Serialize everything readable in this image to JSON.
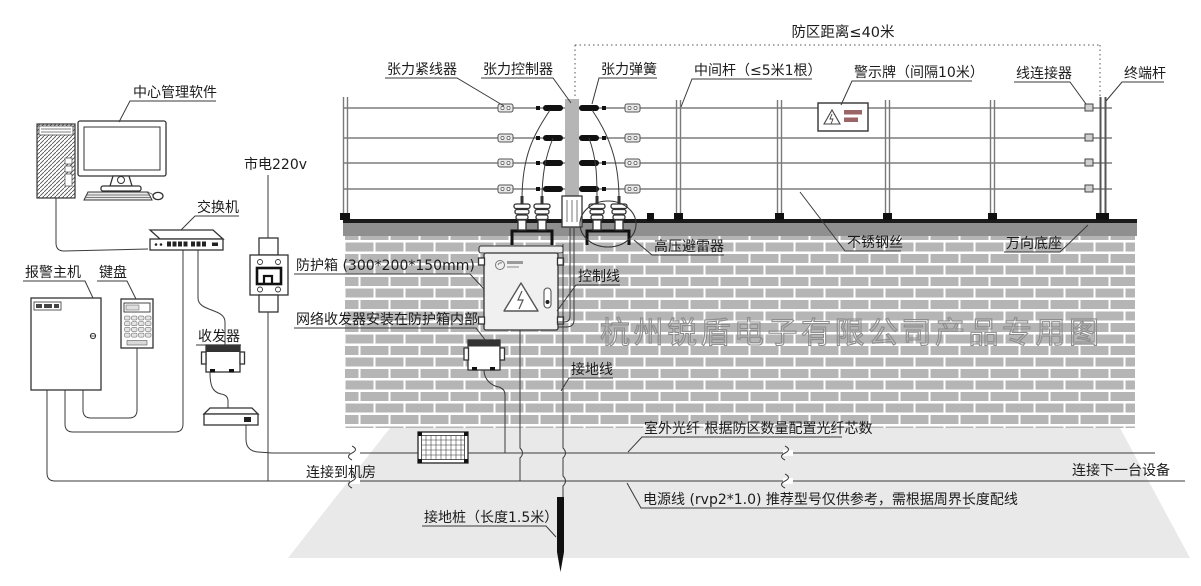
{
  "diagram": {
    "watermark": "杭州锐盾电子有限公司产品专用图",
    "colors": {
      "line": "#3a3a3a",
      "fence_wire": "#8f8f8f",
      "brick": "#b5b5b5",
      "wall_cap": "#8f8f8f",
      "ground": "#e9e9e9",
      "center_post": "#b5b5b5",
      "stake": "#111111",
      "watermark_stroke": "#8d8d8d"
    },
    "labels": {
      "center_software": "中心管理软件",
      "switch": "交换机",
      "alarm_host": "报警主机",
      "keypad": "键盘",
      "transceiver": "收发器",
      "mains": "市电220v",
      "protection_box": "防护箱 (300*200*150mm)",
      "network_transceiver_note": "网络收发器安装在防护箱内部",
      "zone_distance": "防区距离≤40米",
      "tensioner": "张力紧线器",
      "tension_controller": "张力控制器",
      "tension_spring": "张力弹簧",
      "middle_post": "中间杆（≤5米1根）",
      "warning_sign": "警示牌（间隔10米）",
      "wire_connector": "线连接器",
      "terminal_post": "终端杆",
      "hv_arrester": "高压避雷器",
      "stainless_wire": "不锈钢丝",
      "universal_base": "万向底座",
      "control_wire": "控制线",
      "ground_wire": "接地线",
      "outdoor_fiber": "室外光纤 根据防区数量配置光纤芯数",
      "connect_room": "连接到机房",
      "connect_next": "连接下一台设备",
      "power_wire": "电源线 (rvp2*1.0) 推荐型号仅供参考，需根据周界长度配线",
      "ground_stake": "接地桩（长度1.5米）"
    }
  }
}
